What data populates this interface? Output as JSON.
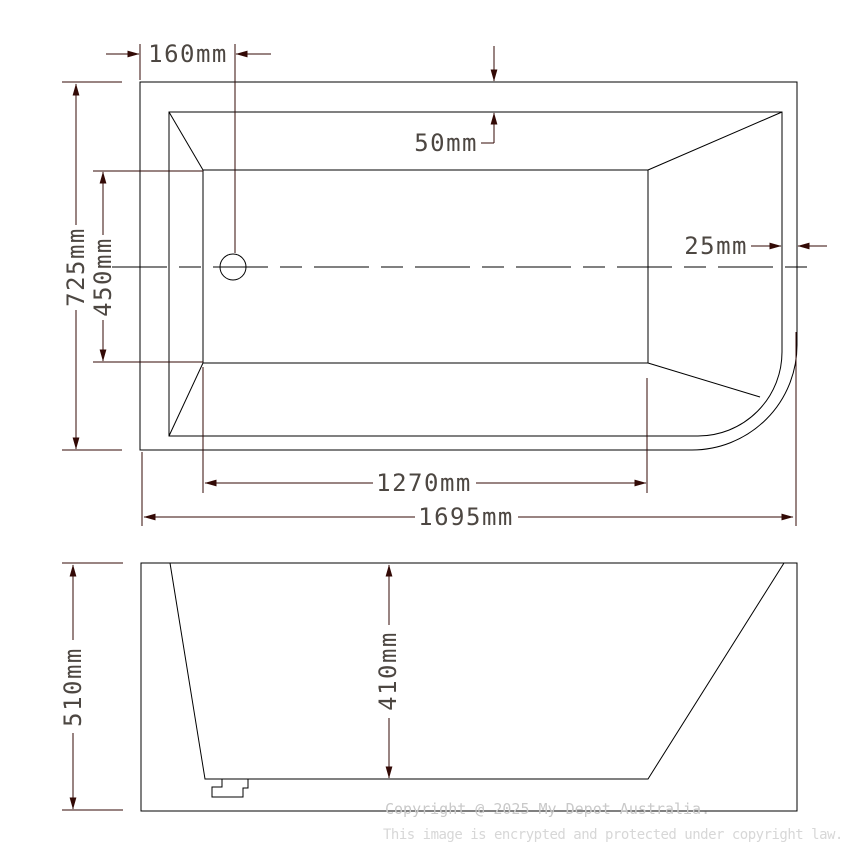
{
  "drawing_type": "bathtub technical dimension drawing, top view and side profile view",
  "dimensions": {
    "top_view": {
      "drain_offset": "160mm",
      "rim_width_top": "50mm",
      "wall_thickness_right": "25mm",
      "overall_width": "725mm",
      "inner_floor_width": "450mm",
      "inner_floor_length": "1270mm",
      "overall_length": "1695mm"
    },
    "side_view": {
      "overall_height": "510mm",
      "inner_depth": "410mm"
    }
  },
  "watermark": {
    "line1": "Copyright @ 2025 My Depot Australia.",
    "line2": "This image is encrypted and protected under copyright law."
  },
  "colors": {
    "geometry_line": "#000000",
    "dimension_line": "#330a06",
    "dimension_text": "#4d4742",
    "watermark_text": "#cccccc",
    "background": "#ffffff"
  }
}
